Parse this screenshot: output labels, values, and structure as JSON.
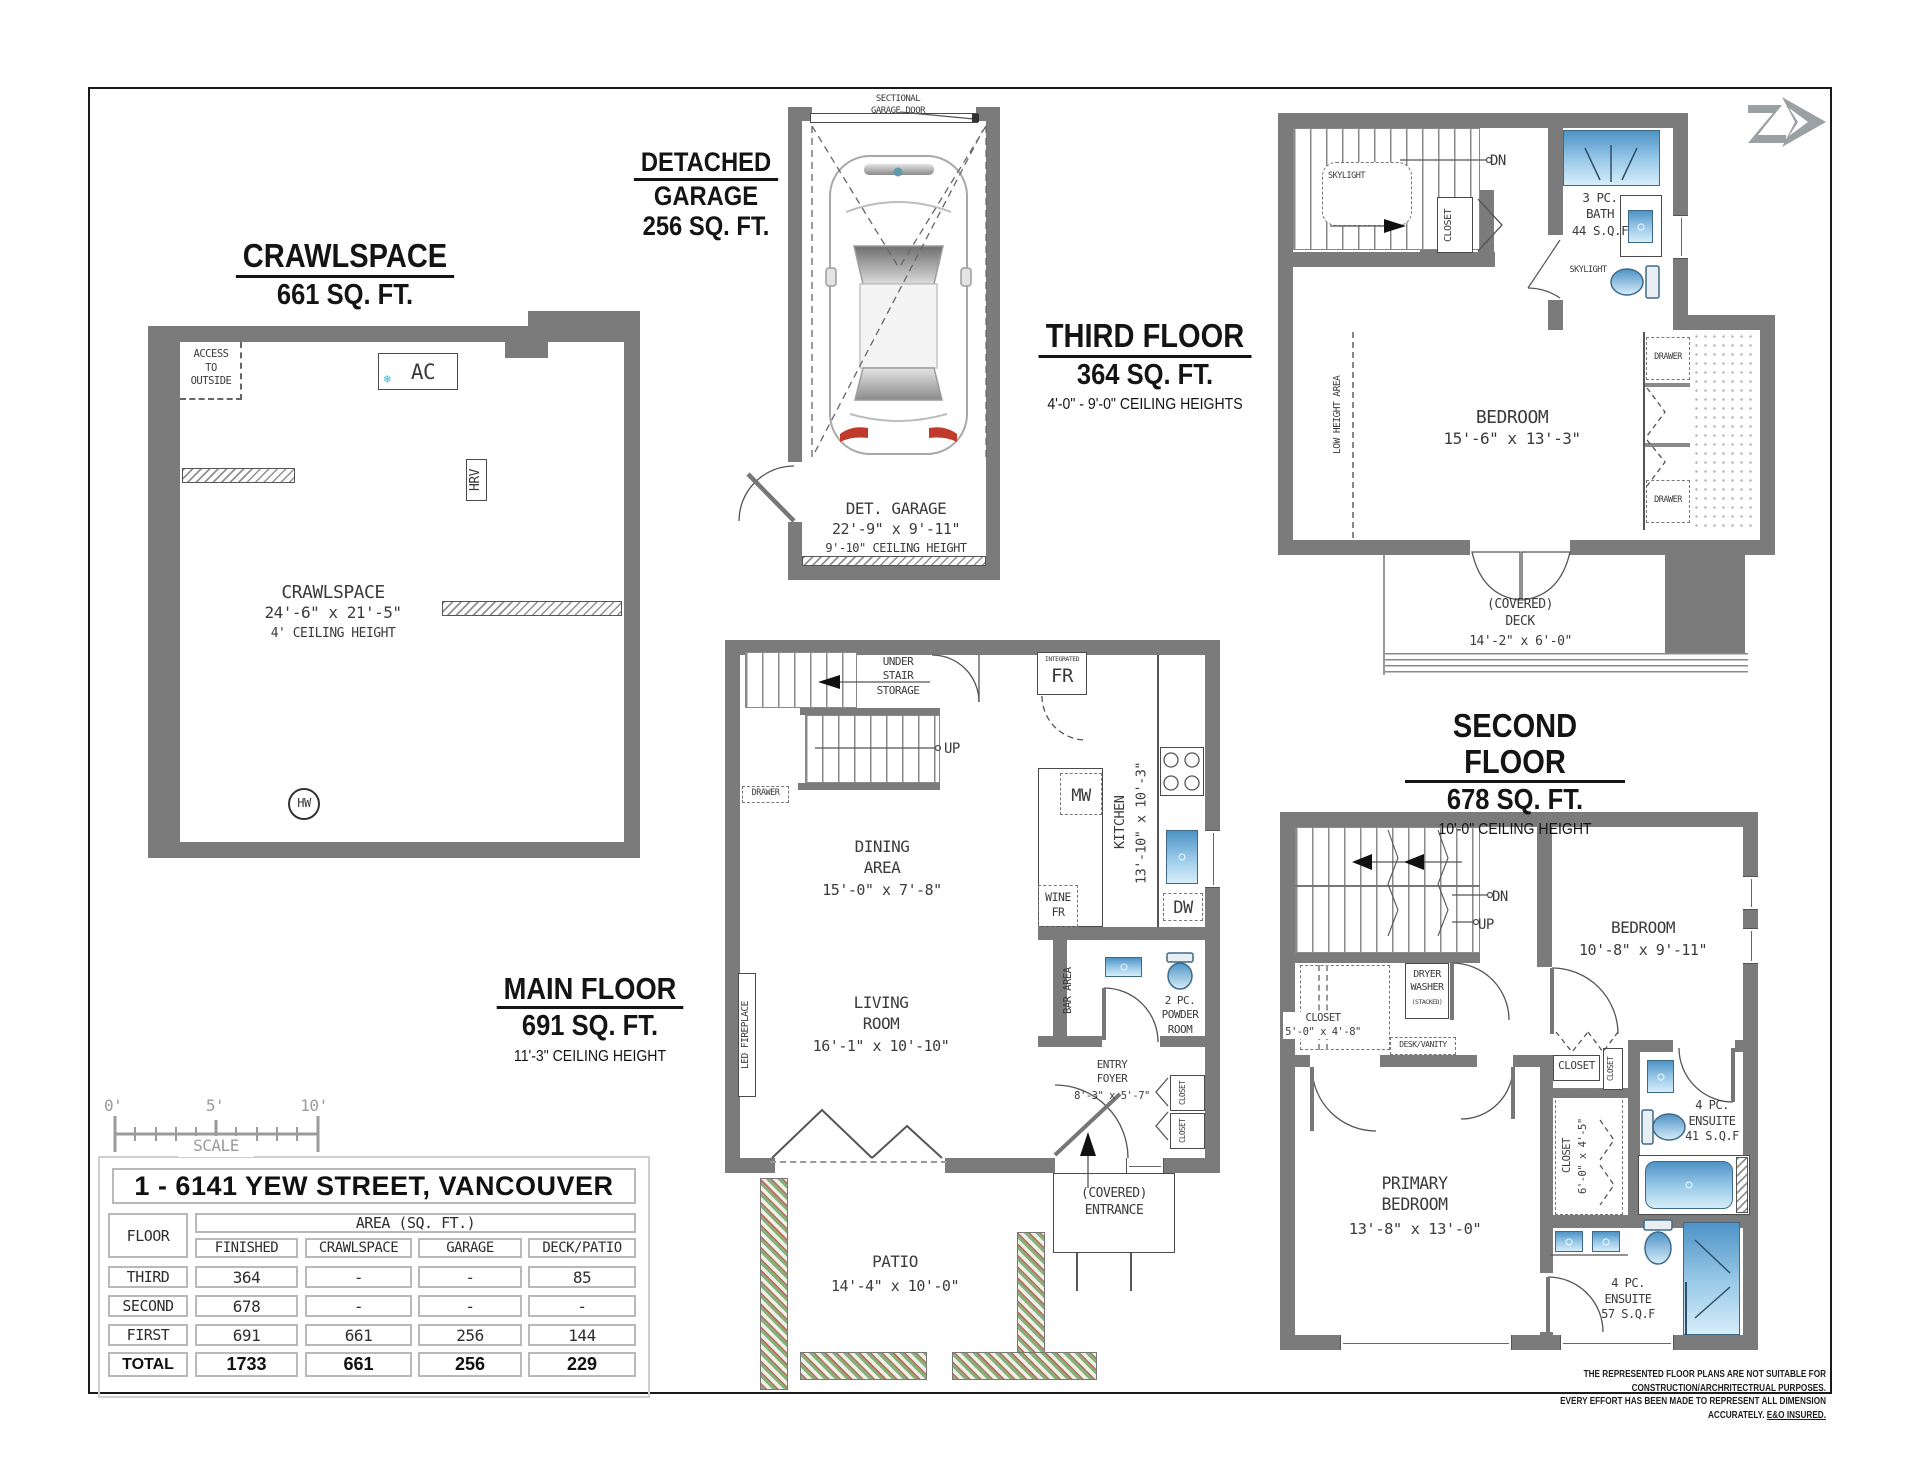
{
  "crawlspace": {
    "title": "CRAWLSPACE",
    "area": "661 SQ. FT.",
    "access": "ACCESS\nTO\nOUTSIDE",
    "ac": "AC",
    "snowflake": "❄",
    "hrv": "HRV",
    "room": "CRAWLSPACE",
    "dims": "24'-6\" x 21'-5\"",
    "ceiling": "4' CEILING HEIGHT",
    "hw": "HW"
  },
  "garage": {
    "title1": "DETACHED",
    "title2": "GARAGE",
    "area": "256 SQ. FT.",
    "door_label": "SECTIONAL\nGARAGE DOOR",
    "room": "DET. GARAGE",
    "dims": "22'-9\" x 9'-11\"",
    "ceiling": "9'-10\" CEILING HEIGHT"
  },
  "third": {
    "title": "THIRD FLOOR",
    "area": "364 SQ. FT.",
    "ceiling": "4'-0\" - 9'-0\" CEILING HEIGHTS",
    "skylight": "SKYLIGHT",
    "skylight2": "SKYLIGHT",
    "dn": "DN",
    "closet": "CLOSET",
    "bath": "3 PC.\nBATH\n44 S.Q.F",
    "bedroom": "BEDROOM",
    "bedroom_dims": "15'-6\" x 13'-3\"",
    "low_height": "LOW HEIGHT AREA",
    "drawer": "DRAWER",
    "deck": "(COVERED)\nDECK",
    "deck_dims": "14'-2\" x 6'-0\""
  },
  "main": {
    "title": "MAIN FLOOR",
    "area": "691 SQ. FT.",
    "ceiling": "11'-3\" CEILING HEIGHT",
    "understair": "UNDER\nSTAIR\nSTORAGE",
    "up": "UP",
    "drawer": "DRAWER",
    "integrated": "INTEGRATED",
    "fr": "FR",
    "dining": "DINING\nAREA",
    "dining_dims": "15'-0\" x 7'-8\"",
    "mw": "MW",
    "kitchen": "KITCHEN\n13'-10\" x 10'-3\"",
    "wine_fr": "WINE\nFR",
    "dw": "DW",
    "living": "LIVING\nROOM",
    "living_dims": "16'-1\" x 10'-10\"",
    "fireplace": "LED FIREPLACE",
    "bar": "BAR AREA",
    "powder": "2 PC.\nPOWDER\nROOM",
    "entry": "ENTRY\nFOYER",
    "entry_dims": "8'-3\" x 5'-7\"",
    "closet": "CLOSET",
    "entrance": "(COVERED)\nENTRANCE",
    "patio": "PATIO",
    "patio_dims": "14'-4\" x 10'-0\""
  },
  "second": {
    "title": "SECOND FLOOR",
    "area": "678 SQ. FT.",
    "ceiling": "10'-0\" CEILING HEIGHT",
    "dn": "DN",
    "up": "UP",
    "closet_a": "CLOSET\n5'-0\" x 4'-8\"",
    "dryer": "DRYER\nWASHER",
    "stacked": "(STACKED)",
    "desk": "DESK/VANITY",
    "bedroom": "BEDROOM",
    "bedroom_dims": "10'-8\" x 9'-11\"",
    "closet": "CLOSET",
    "closet_b": "CLOSET\n6'-0\" x 4'-5\"",
    "ensuite_a": "4 PC.\nENSUITE\n41 S.Q.F",
    "ensuite_b": "4 PC.\nENSUITE\n57 S.Q.F",
    "primary": "PRIMARY\nBEDROOM",
    "primary_dims": "13'-8\" x 13'-0\""
  },
  "table": {
    "title": "1 - 6141 YEW STREET, VANCOUVER",
    "floor": "FLOOR",
    "area_header": "AREA (SQ. FT.)",
    "col_finished": "FINISHED",
    "col_crawlspace": "CRAWLSPACE",
    "col_garage": "GARAGE",
    "col_deck": "DECK/PATIO",
    "rows": [
      {
        "floor": "THIRD",
        "finished": "364",
        "crawlspace": "-",
        "garage": "-",
        "deck": "85"
      },
      {
        "floor": "SECOND",
        "finished": "678",
        "crawlspace": "-",
        "garage": "-",
        "deck": "-"
      },
      {
        "floor": "FIRST",
        "finished": "691",
        "crawlspace": "661",
        "garage": "256",
        "deck": "144"
      },
      {
        "floor": "TOTAL",
        "finished": "1733",
        "crawlspace": "661",
        "garage": "256",
        "deck": "229"
      }
    ]
  },
  "scalebar": {
    "zero": "0'",
    "five": "5'",
    "ten": "10'",
    "label": "SCALE"
  },
  "disclaimer": {
    "line1": "THE REPRESENTED FLOOR PLANS ARE NOT SUITABLE FOR CONSTRUCTION/ARCHRITECTRUAL PURPOSES.",
    "line2": "EVERY EFFORT HAS BEEN MADE TO REPRESENT ALL DIMENSION ACCURATELY.",
    "eo": "E&O INSURED."
  },
  "colors": {
    "wall": "#7b7b7b",
    "fixture_blue": "#4e93c6",
    "accent_cyan": "#35b6d9",
    "logo_gray": "#99a1a5"
  }
}
